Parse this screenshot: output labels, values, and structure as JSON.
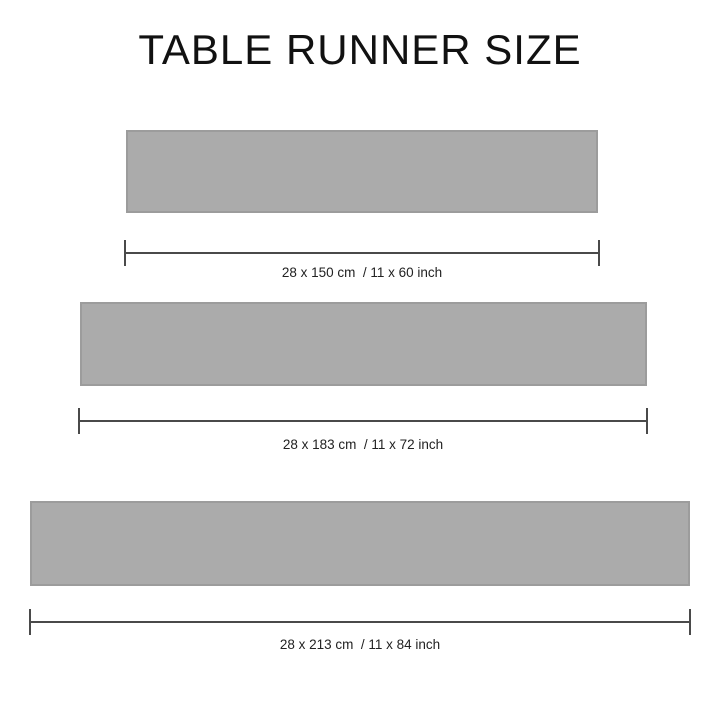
{
  "title": "TABLE RUNNER SIZE",
  "sizes": [
    {
      "label": "28 x 150 cm  / 11 x 60 inch",
      "cm": "28 x 150 cm",
      "inch": "11 x 60 inch"
    },
    {
      "label": "28 x 183 cm  / 11 x 72 inch",
      "cm": "28 x 183 cm",
      "inch": "11 x 72 inch"
    },
    {
      "label": "28 x 213 cm  / 11 x 84 inch",
      "cm": "28 x 213 cm",
      "inch": "11 x 84 inch"
    }
  ],
  "colors": {
    "background": "#FFFFFF",
    "runner_fill": "#ABABAB",
    "runner_border": "#9C9C9C",
    "dimension_line": "#4A4A4A",
    "text": "#222222",
    "title_text": "#111111"
  }
}
